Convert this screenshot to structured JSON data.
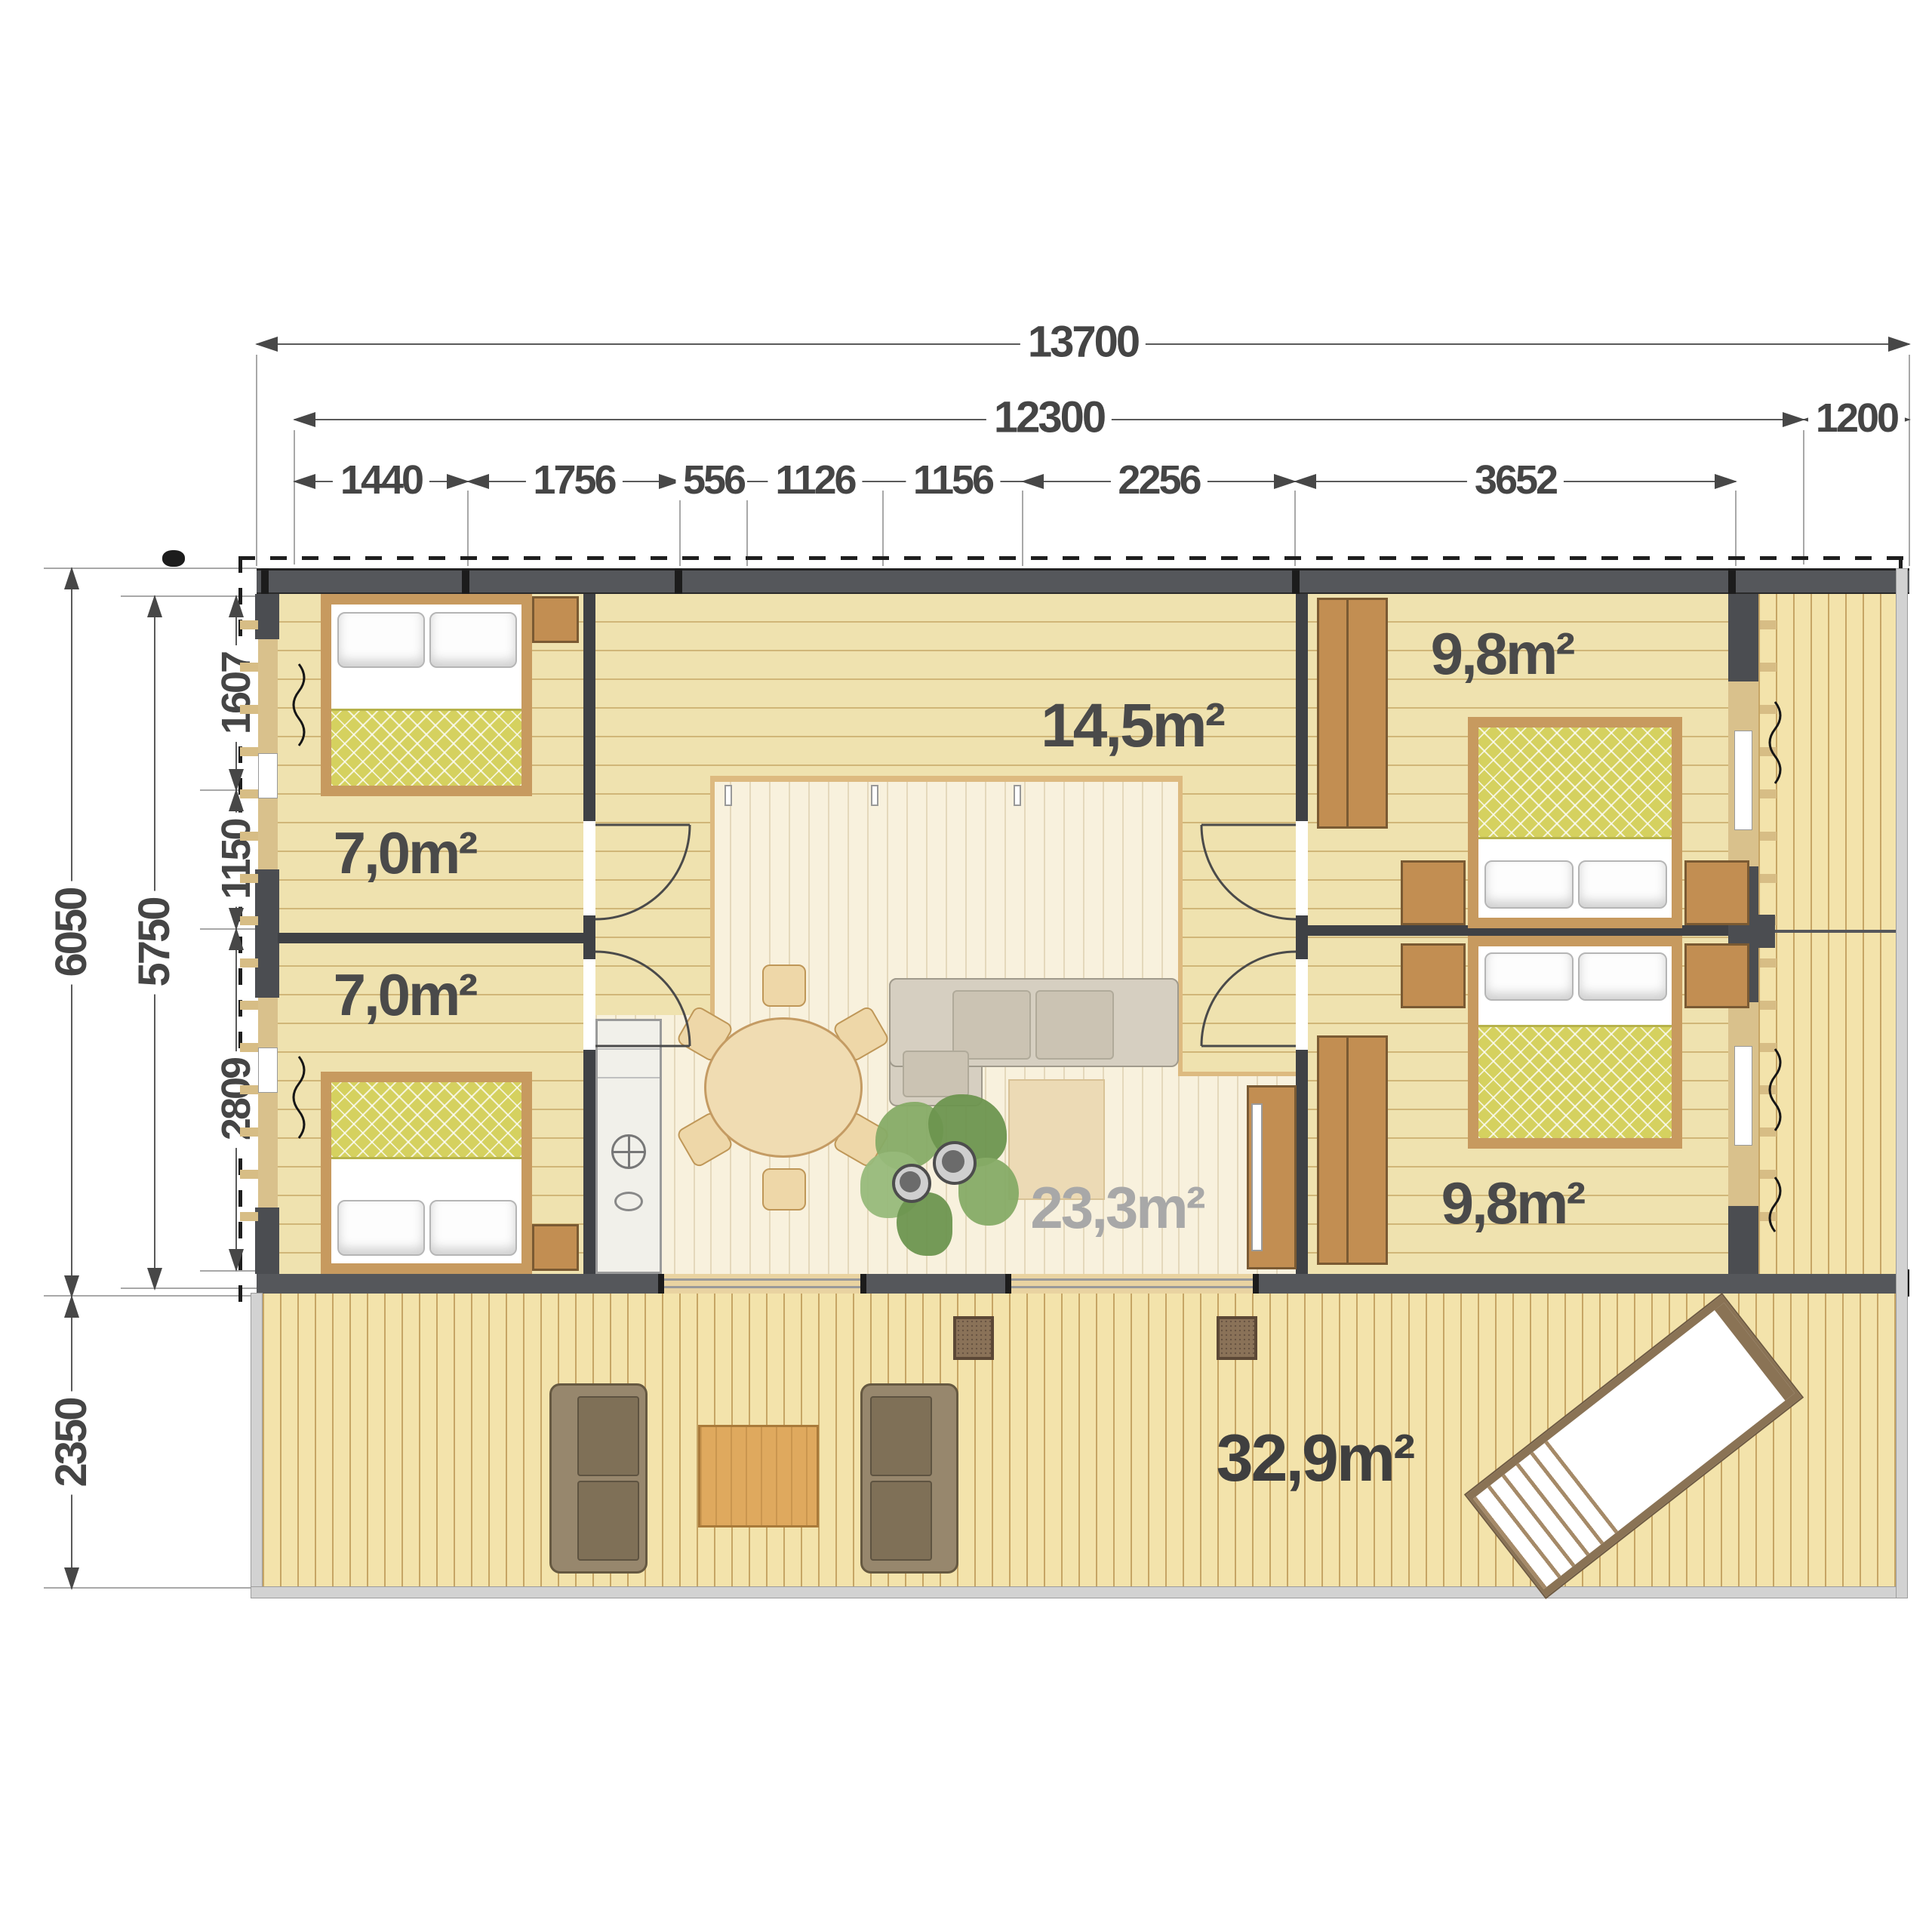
{
  "dimensions": {
    "top": {
      "total": "13700",
      "main": "12300",
      "side": "1200",
      "segments": [
        "1440",
        "1756",
        "556",
        "1126",
        "1156",
        "2256",
        "3652"
      ]
    },
    "left": {
      "total": "6050",
      "inner": "5750",
      "upper": "1607",
      "middle": "1150",
      "lower": "2809",
      "terrace": "2350"
    }
  },
  "areas": {
    "bedroom_left_top": "7,0m²",
    "bedroom_left_bottom": "7,0m²",
    "hall": "14,5m²",
    "bedroom_right_top": "9,8m²",
    "bedroom_right_bottom": "9,8m²",
    "living": "23,3m²",
    "terrace": "32,9m²"
  },
  "colors": {
    "dimension_text": "#454545",
    "wall": "#55575b",
    "interior_wall": "#3f4145",
    "room_floor": "#efe2af",
    "living_floor": "#f8f1dd",
    "terrace_floor": "#f3e3ab",
    "wood_furniture": "#c28e52",
    "quilt_green": "#d5d15f",
    "muted_label": "#a8a8a8"
  }
}
